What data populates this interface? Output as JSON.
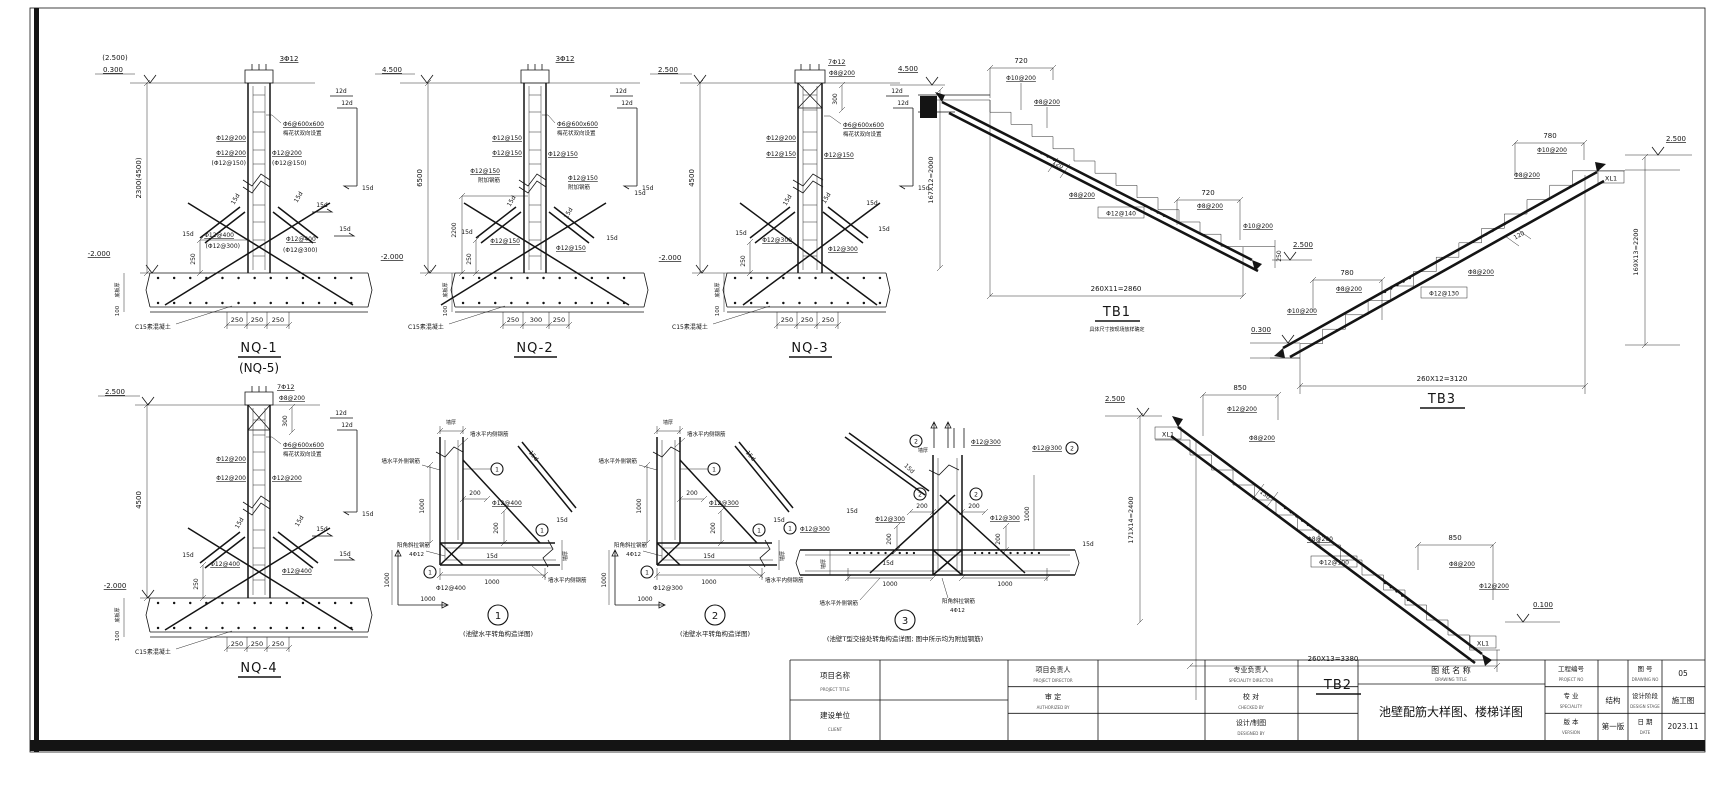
{
  "r": {
    "d12": "12d",
    "d15": "15d",
    "f6tie": "Φ6@600x600",
    "plum": "梅花状双向设置",
    "addbar": "附加钢筋",
    "f12_200": "Φ12@200",
    "f12_150": "Φ12@150",
    "f12_150p": "(Φ12@150)",
    "f12_300": "Φ12@300",
    "f12_300p": "(Φ12@300)",
    "f12_400": "Φ12@400",
    "f12_140": "Φ12@140",
    "f12_130": "Φ12@130",
    "f12_100": "Φ12@100",
    "f10_200": "Φ10@200",
    "f8_200": "Φ8@200",
    "n100": "100",
    "n120": "120",
    "n130": "130",
    "n200": "200",
    "n250": "250",
    "n300": "300",
    "n720": "720",
    "n780": "780",
    "n850": "850",
    "n1000": "1000",
    "n2200": "2200",
    "c15": "C15素混凝土",
    "slab": "底板厚",
    "wall": "墙厚",
    "inner": "墙水平内侧钢筋",
    "outer": "墙水平外侧钢筋",
    "corner": "阳角斜拉钢筋",
    "four12": "4Φ12",
    "xl1": "XL1",
    "lv_245": "(2.500)",
    "lv_03": "0.300",
    "lv_45": "4.500",
    "lv_25": "2.500",
    "lv_m2": "-2.000",
    "lv_01": "0.100",
    "bar3": "3Φ12",
    "bar7": "7Φ12"
  },
  "nq1": {
    "title": "NQ-1",
    "sub": "(NQ-5)",
    "height": "2300(4500)"
  },
  "nq2": {
    "title": "NQ-2",
    "height": "6500",
    "h2": "2200"
  },
  "nq3": {
    "title": "NQ-3",
    "height": "4500"
  },
  "nq4": {
    "title": "NQ-4",
    "height": "4500"
  },
  "details": {
    "d1": {
      "num": "1",
      "bar": "Φ12@400",
      "cap": "(池壁水平转角构造详图)"
    },
    "d2": {
      "num": "2",
      "bar": "Φ12@300",
      "cap": "(池壁水平转角构造详图)"
    },
    "d3": {
      "num": "3",
      "cap": "(池壁T型交接处转角构造详图; 图中所示均为附加钢筋)"
    }
  },
  "tb1": {
    "label": "TB1",
    "note": "具体尺寸按现场放样确定",
    "run": "260X11=2860",
    "rise": "167X12=2000"
  },
  "tb2": {
    "label": "TB2",
    "run": "260X13=3380",
    "rise": "171X14=2400"
  },
  "tb3": {
    "label": "TB3",
    "run": "260X12=3120",
    "rise": "169X13=2200"
  },
  "titleblock": {
    "project_label": "项目名称",
    "project_en": "PROJECT TITLE",
    "client_label": "建设单位",
    "client_en": "CLIENT",
    "pm_label": "项目负责人",
    "pm_en": "PROJECT DIRECTOR",
    "auth_label": "审 定",
    "auth_en": "AUTHORIZED BY",
    "lead_label": "专业负责人",
    "lead_en": "SPECIALITY DIRECTOR",
    "check_label": "校 对",
    "check_en": "CHECKED BY",
    "design_label": "设计/制图",
    "design_en": "DESIGNED BY",
    "title_label": "图 纸 名 称",
    "title_en": "DRAWING TITLE",
    "drawing_title": "池壁配筋大样图、楼梯详图",
    "projno_label": "工程编号",
    "projno_en": "PROJECT NO",
    "figno_label": "图 号",
    "figno_en": "DRAWING NO",
    "figno_value": "05",
    "spec_label": "专 业",
    "spec_en": "SPECIALITY",
    "spec_value": "结构",
    "stage_label": "设计阶段",
    "stage_en": "DESIGN STAGE",
    "stage_value": "施工图",
    "ver_label": "版 本",
    "ver_en": "VERSION",
    "ver_value": "第一版",
    "date_label": "日 期",
    "date_en": "DATE",
    "date_value": "2023.11"
  }
}
